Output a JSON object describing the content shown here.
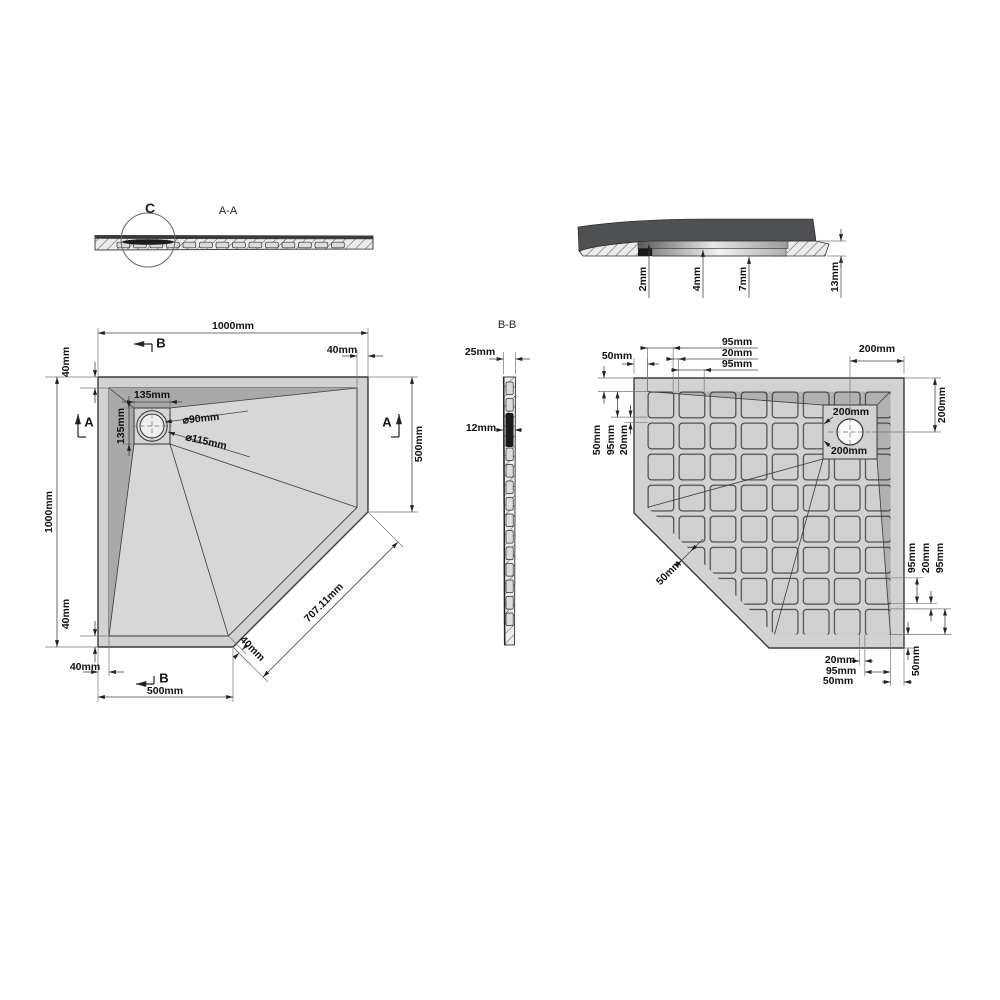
{
  "colors": {
    "outline": "#3a3a3a",
    "body_gray": "#d2d2d2",
    "floor_gray": "#d7d7d7",
    "slope_gray": "#a9a9a9",
    "grid_square": "#d0d0d0",
    "section_dark": "#4e5052",
    "hatch_bg": "#ebebeb",
    "drain_white": "#fafafa",
    "dim_text": "#111111"
  },
  "views": {
    "section_aa": {
      "title": "A-A",
      "detail_marker": "C"
    },
    "section_bb": {
      "title": "B-B"
    },
    "detail_c": {
      "marker": "C"
    }
  },
  "labels": [
    {
      "id": "detailc-dim-2mm",
      "t": "2mm",
      "x": 643,
      "y": 279,
      "r": -90,
      "b": 1
    },
    {
      "id": "detailc-dim-4mm",
      "t": "4mm",
      "x": 697,
      "y": 279,
      "r": -90,
      "b": 1
    },
    {
      "id": "detailc-dim-7mm",
      "t": "7mm",
      "x": 743,
      "y": 279,
      "r": -90,
      "b": 1
    },
    {
      "id": "detailc-dim-13mm",
      "t": "13mm",
      "x": 835,
      "y": 277,
      "r": -90,
      "b": 1
    },
    {
      "id": "bb-dim-25mm",
      "t": "25mm",
      "x": 480,
      "y": 352,
      "b": 1
    },
    {
      "id": "bb-dim-12mm",
      "t": "12mm",
      "x": 481,
      "y": 428,
      "b": 1
    },
    {
      "id": "plan-dim-width",
      "t": "1000mm",
      "x": 233,
      "y": 326,
      "b": 1
    },
    {
      "id": "plan-section-b-top",
      "t": "B",
      "x": 161,
      "y": 343,
      "s": 13,
      "b": 1
    },
    {
      "id": "plan-dim-rim-top-left",
      "t": "40mm",
      "x": 66,
      "y": 362,
      "r": -90,
      "b": 1
    },
    {
      "id": "plan-dim-height",
      "t": "1000mm",
      "x": 49,
      "y": 512,
      "r": -90,
      "b": 1
    },
    {
      "id": "plan-section-a-left",
      "t": "A",
      "x": 89,
      "y": 422,
      "s": 13,
      "b": 1
    },
    {
      "id": "plan-dim-drain-square-w",
      "t": "135mm",
      "x": 152,
      "y": 395,
      "b": 1
    },
    {
      "id": "plan-dim-drain-square-h",
      "t": "135mm",
      "x": 121,
      "y": 426,
      "r": -90,
      "b": 1
    },
    {
      "id": "plan-dim-drain-inner-dia",
      "t": "⌀90mm",
      "x": 201,
      "y": 419,
      "r": -6,
      "b": 1
    },
    {
      "id": "plan-dim-drain-outer-dia",
      "t": "⌀115mm",
      "x": 206,
      "y": 442,
      "r": 13,
      "b": 1
    },
    {
      "id": "plan-dim-rim-top-right",
      "t": "40mm",
      "x": 342,
      "y": 350,
      "b": 1
    },
    {
      "id": "plan-section-a-right",
      "t": "A",
      "x": 387,
      "y": 422,
      "s": 13,
      "b": 1
    },
    {
      "id": "plan-dim-right-500",
      "t": "500mm",
      "x": 419,
      "y": 444,
      "r": -90,
      "b": 1
    },
    {
      "id": "plan-dim-diagonal",
      "t": "707.11mm",
      "x": 324,
      "y": 603,
      "r": -45,
      "b": 1
    },
    {
      "id": "plan-dim-rim-diagonal",
      "t": "40mm",
      "x": 252,
      "y": 649,
      "r": 45,
      "b": 1
    },
    {
      "id": "plan-dim-rim-bottom-left-v",
      "t": "40mm",
      "x": 66,
      "y": 614,
      "r": -90,
      "b": 1
    },
    {
      "id": "plan-dim-rim-bottom-left-h",
      "t": "40mm",
      "x": 85,
      "y": 667,
      "b": 1
    },
    {
      "id": "plan-section-b-bottom",
      "t": "B",
      "x": 164,
      "y": 678,
      "s": 13,
      "b": 1
    },
    {
      "id": "plan-dim-bottom-500",
      "t": "500mm",
      "x": 165,
      "y": 691,
      "b": 1
    },
    {
      "id": "bottom-dim-margin-top-left",
      "t": "50mm",
      "x": 617,
      "y": 356,
      "b": 1
    },
    {
      "id": "bottom-dim-col1",
      "t": "95mm",
      "x": 737,
      "y": 342,
      "b": 1
    },
    {
      "id": "bottom-dim-gap1",
      "t": "20mm",
      "x": 737,
      "y": 353,
      "b": 1
    },
    {
      "id": "bottom-dim-col2",
      "t": "95mm",
      "x": 737,
      "y": 364,
      "b": 1
    },
    {
      "id": "bottom-dim-drain-x",
      "t": "200mm",
      "x": 877,
      "y": 349,
      "b": 1
    },
    {
      "id": "bottom-dim-drain-y",
      "t": "200mm",
      "x": 942,
      "y": 405,
      "r": -90,
      "b": 1
    },
    {
      "id": "bottom-dim-row-left-50",
      "t": "50mm",
      "x": 597,
      "y": 440,
      "r": -90,
      "b": 1
    },
    {
      "id": "bottom-dim-row-left-95",
      "t": "95mm",
      "x": 611,
      "y": 440,
      "r": -90,
      "b": 1
    },
    {
      "id": "bottom-dim-row-left-20",
      "t": "20mm",
      "x": 624,
      "y": 440,
      "r": -90,
      "b": 1
    },
    {
      "id": "bottom-dim-drain-sq-top",
      "t": "200mm",
      "x": 851,
      "y": 412,
      "b": 1
    },
    {
      "id": "bottom-dim-drain-sq-bottom",
      "t": "200mm",
      "x": 849,
      "y": 451,
      "b": 1
    },
    {
      "id": "bottom-dim-rim-diagonal",
      "t": "50mm",
      "x": 669,
      "y": 573,
      "r": -45,
      "b": 1
    },
    {
      "id": "bottom-dim-row-right-95a",
      "t": "95mm",
      "x": 912,
      "y": 558,
      "r": -90,
      "b": 1
    },
    {
      "id": "bottom-dim-row-right-20",
      "t": "20mm",
      "x": 926,
      "y": 558,
      "r": -90,
      "b": 1
    },
    {
      "id": "bottom-dim-row-right-95b",
      "t": "95mm",
      "x": 940,
      "y": 558,
      "r": -90,
      "b": 1
    },
    {
      "id": "bottom-dim-margin-br-v",
      "t": "50mm",
      "x": 916,
      "y": 661,
      "r": -90,
      "b": 1
    },
    {
      "id": "bottom-dim-gap-bottom",
      "t": "20mm",
      "x": 840,
      "y": 660,
      "b": 1
    },
    {
      "id": "bottom-dim-col8-bottom",
      "t": "95mm",
      "x": 841,
      "y": 671,
      "b": 1
    },
    {
      "id": "bottom-dim-margin-bottom-h",
      "t": "50mm",
      "x": 838,
      "y": 681,
      "b": 1
    }
  ]
}
